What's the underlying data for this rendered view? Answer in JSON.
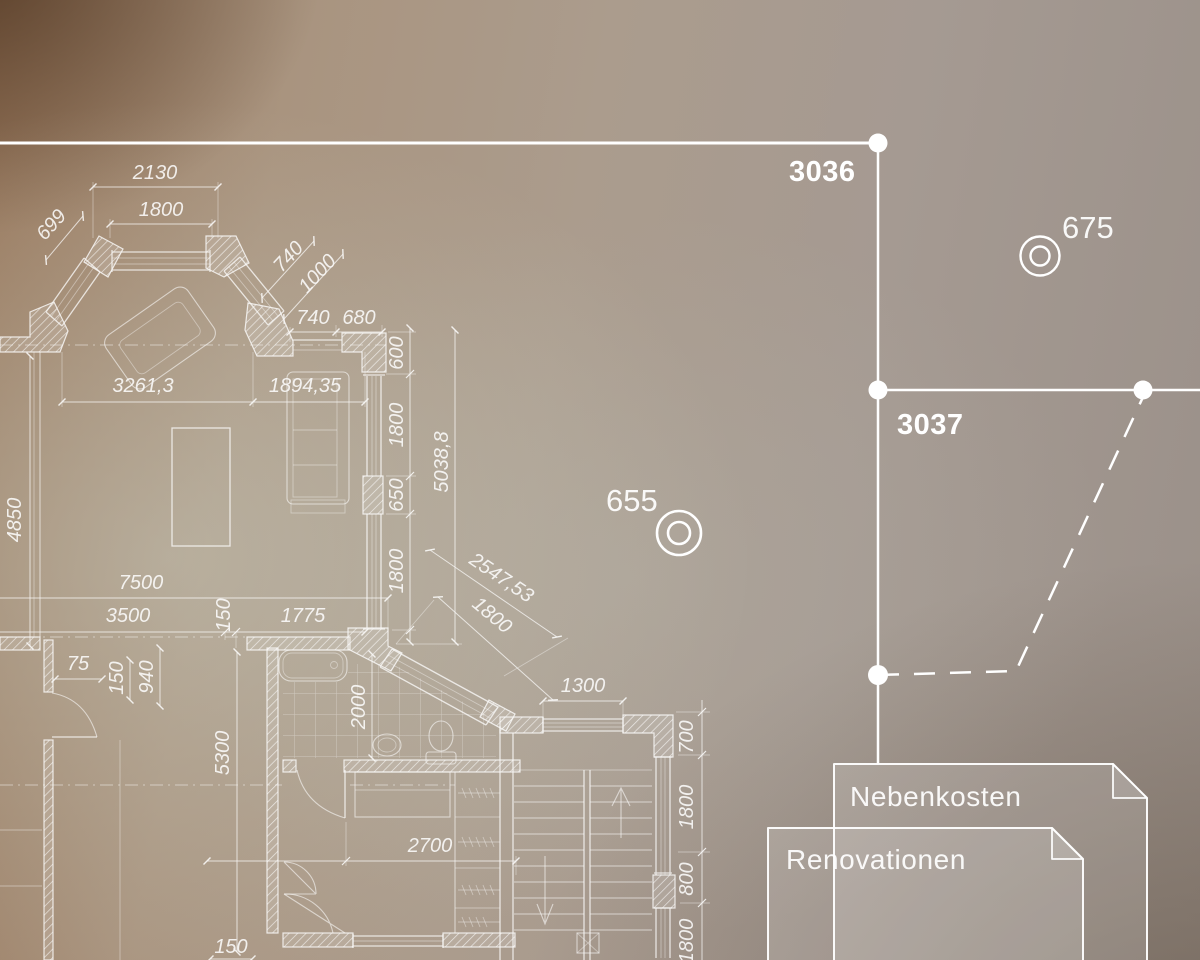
{
  "overlay": {
    "accent_color": "#ffffff",
    "markers": [
      {
        "label": "3036"
      },
      {
        "label": "3037"
      }
    ],
    "poi": [
      {
        "label": "675"
      },
      {
        "label": "655"
      }
    ],
    "documents": [
      {
        "label": "Nebenkosten"
      },
      {
        "label": "Renovationen"
      }
    ]
  },
  "plan": {
    "line_color": "#ffffff",
    "dims": [
      "2130",
      "1800",
      "699",
      "740",
      "1000",
      "740",
      "680",
      "600",
      "1800",
      "650",
      "1800",
      "5038,8",
      "3261,3",
      "1894,35",
      "4850",
      "7500",
      "3500",
      "150",
      "1775",
      "75",
      "150",
      "940",
      "5300",
      "2000",
      "2547,53",
      "1800",
      "1300",
      "2700",
      "150",
      "700",
      "1800",
      "800",
      "1800"
    ]
  }
}
